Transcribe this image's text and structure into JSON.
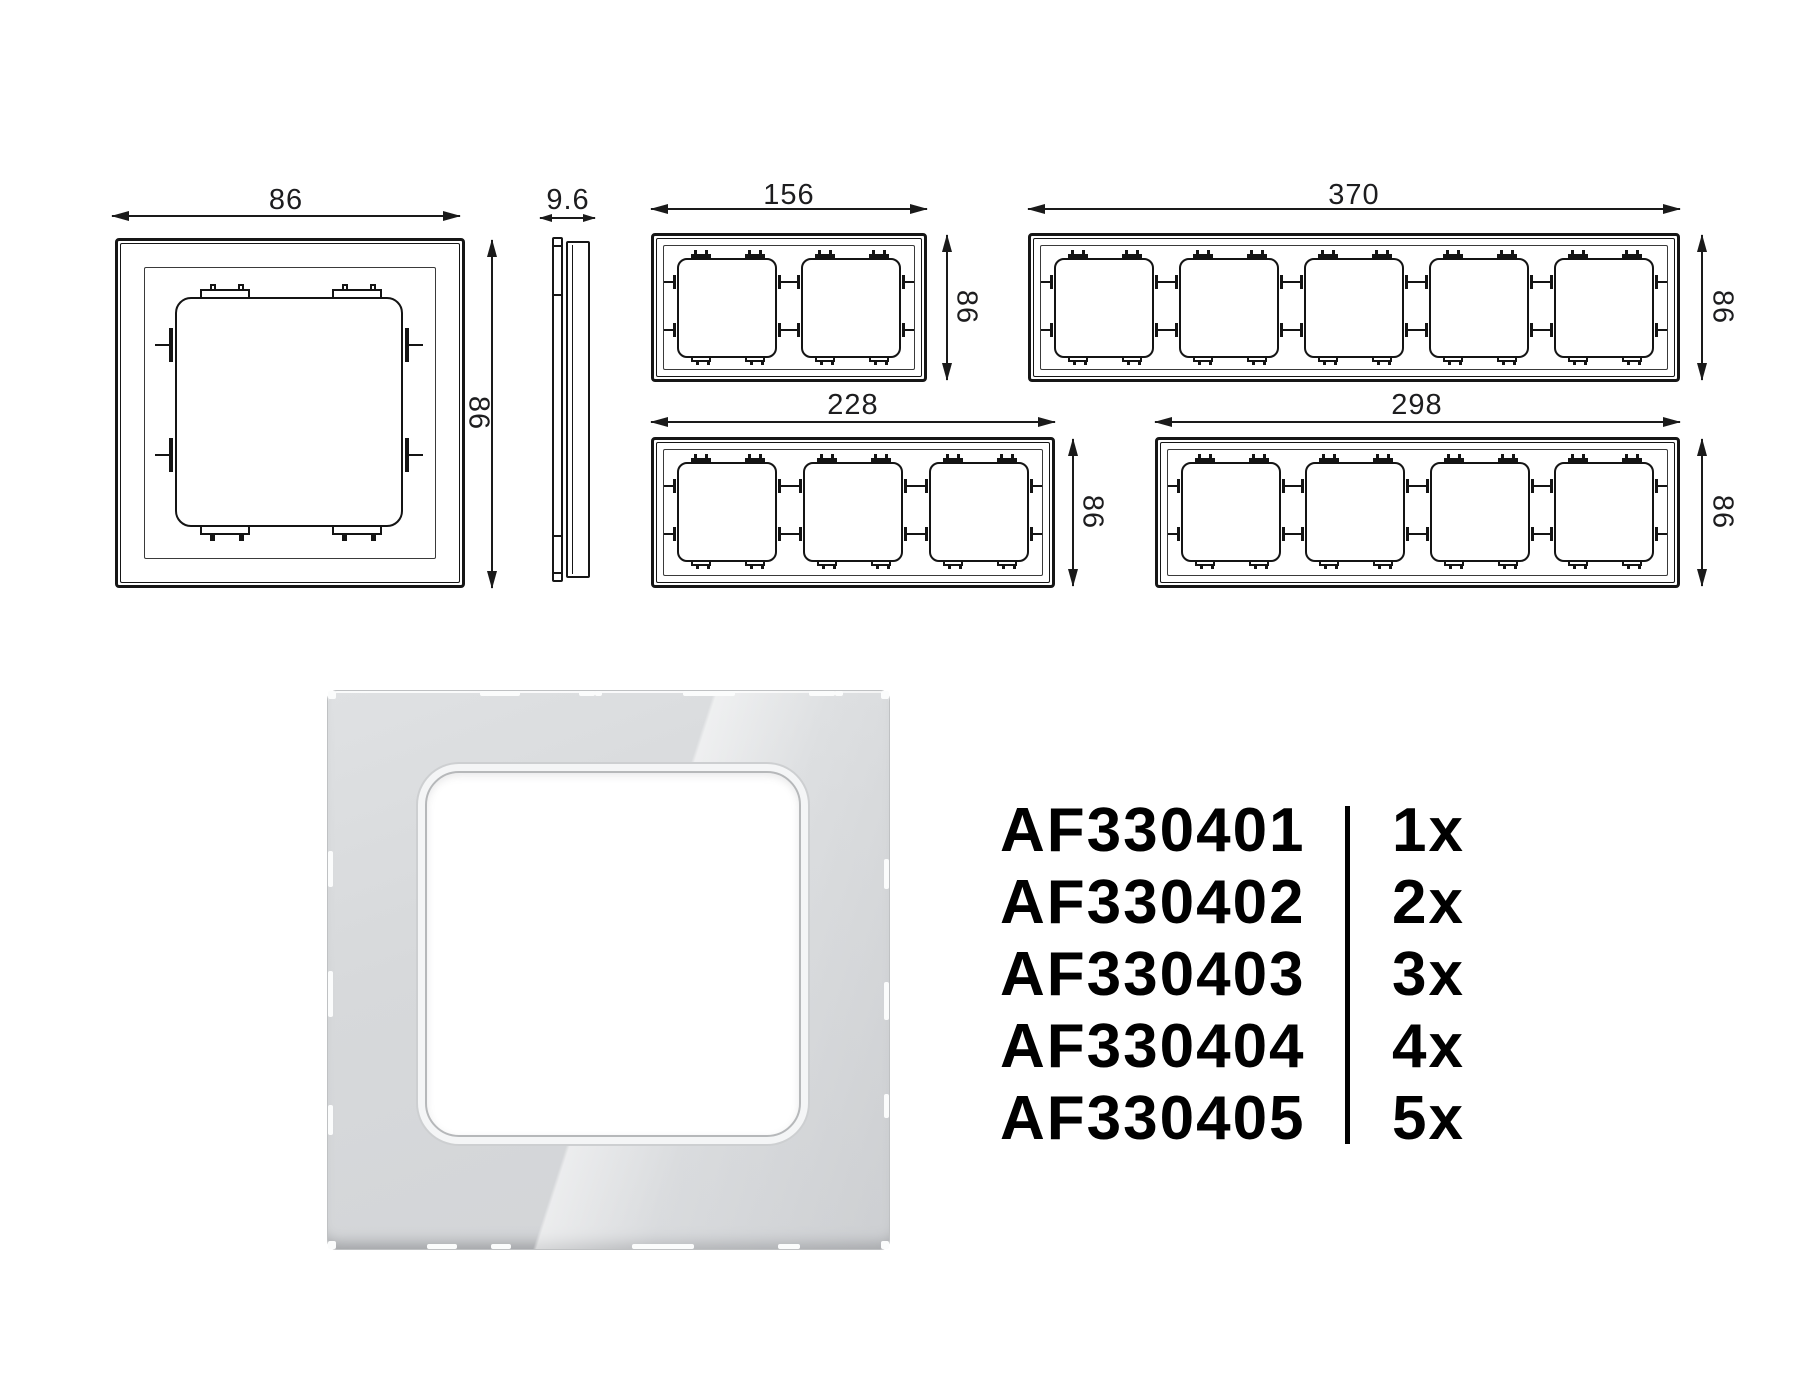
{
  "page": {
    "background": "#ffffff"
  },
  "drawings": {
    "single_back_view": {
      "width_label": "86",
      "height_label": "86",
      "gangs": 1
    },
    "side_profile": {
      "depth_label": "9.6"
    },
    "frames": [
      {
        "name": "2-gang",
        "gangs": 2,
        "width_label": "156",
        "height_label": "86"
      },
      {
        "name": "5-gang",
        "gangs": 5,
        "width_label": "370",
        "height_label": "86"
      },
      {
        "name": "3-gang",
        "gangs": 3,
        "width_label": "228",
        "height_label": "86"
      },
      {
        "name": "4-gang",
        "gangs": 4,
        "width_label": "298",
        "height_label": "86"
      }
    ]
  },
  "parts_list": {
    "rows": [
      {
        "code": "AF330401",
        "qty": "1x"
      },
      {
        "code": "AF330402",
        "qty": "2x"
      },
      {
        "code": "AF330403",
        "qty": "3x"
      },
      {
        "code": "AF330404",
        "qty": "4x"
      },
      {
        "code": "AF330405",
        "qty": "5x"
      }
    ]
  },
  "colors": {
    "line": "#1a1a1a",
    "text": "#000000",
    "plate": "#d6d8da",
    "opening": "#ffffff"
  }
}
